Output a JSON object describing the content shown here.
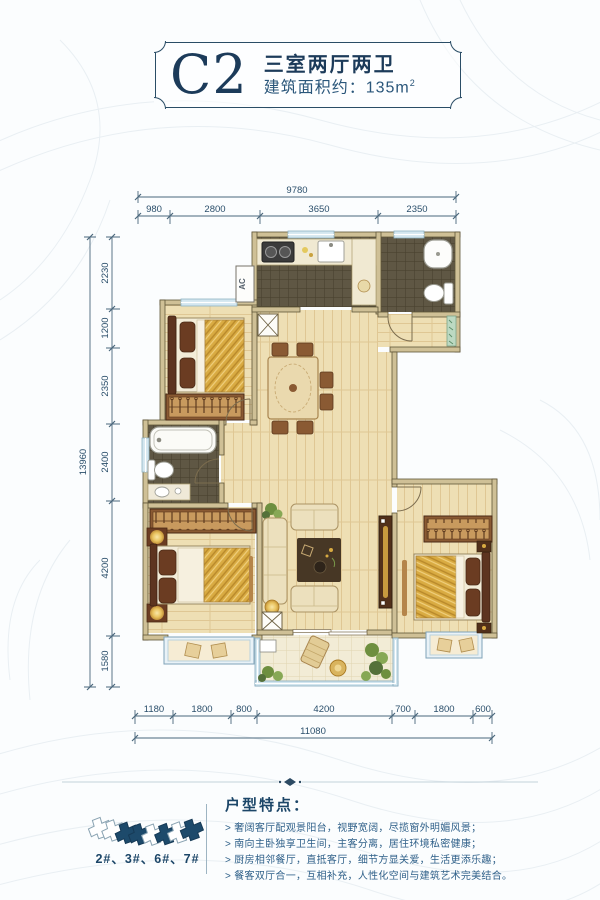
{
  "title_card": {
    "code": "C2",
    "type": "三室两厅两卫",
    "area_label": "建筑面积约：135m",
    "area_sup": "2"
  },
  "plan": {
    "ac_label": "AC",
    "dims": {
      "top": {
        "total": "9780",
        "segments": [
          "980",
          "2800",
          "3650",
          "2350"
        ]
      },
      "left": {
        "total": "13960",
        "segments": [
          "2230",
          "1200",
          "2350",
          "2400",
          "4200",
          "1580"
        ]
      },
      "bottom": {
        "total": "11080",
        "segments": [
          "1180",
          "1800",
          "800",
          "4200",
          "700",
          "1800",
          "600"
        ]
      }
    }
  },
  "footer": {
    "buildings_label": "2#、3#、6#、7#",
    "features_title": "户型特点：",
    "features": [
      "> 奢阔客厅配观景阳台，视野宽阔，尽揽窗外明媚风景；",
      "> 南向主卧独享卫生间，主客分离，居住环境私密健康；",
      "> 厨房相邻餐厅，直抵客厅，细节方显关爱，生活更添乐趣；",
      "> 餐客双厅合一，互相补充，人性化空间与建筑艺术完美结合。"
    ]
  },
  "colors": {
    "navy": "#1c3b5a",
    "dim_line": "#3f5a6e",
    "wall_fill": "#cfc096",
    "wood_floor": "#eedfb4",
    "dark_tile": "#5f5744",
    "window_glass": "#d3e6ef",
    "bed_gold": "#d9ab42"
  }
}
